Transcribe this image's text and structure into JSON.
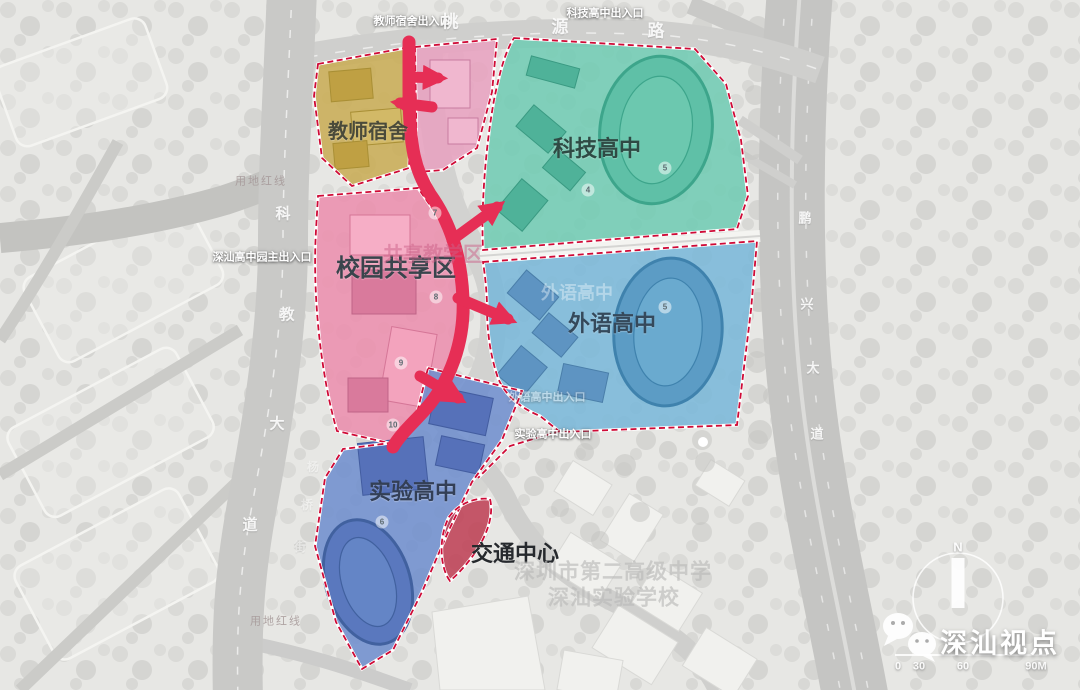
{
  "zones": {
    "teacher_dorm": {
      "label": "教师宿舍",
      "color": "#c9ac55"
    },
    "campus_shared": {
      "label": "校园共享区",
      "color": "#ec8fae"
    },
    "tech_high": {
      "label": "科技高中",
      "color": "#70cbb3"
    },
    "foreign_lang_high": {
      "label": "外语高中",
      "color": "#7ab8d9"
    },
    "experimental_high": {
      "label": "实验高中",
      "color": "#6f8fce"
    },
    "transport_center": {
      "label": "交通中心",
      "color": "#bf4055"
    }
  },
  "ghost_labels": {
    "shared_teaching": "共享教学区",
    "foreign_lang": "外语高中",
    "school_name_line1": "深圳市第二高级中学",
    "school_name_line2": "深汕实验学校"
  },
  "entrances": {
    "dorm_exit": "教师宿舍出入口",
    "tech_exit": "科技高中出入口",
    "main_entrance": "深汕高中园主出入口",
    "foreign_exit": "外语高中出入口",
    "experimental_exit": "实验高中出入口"
  },
  "roads": {
    "taoyuan": [
      "桃",
      "源",
      "路"
    ],
    "kejiao": [
      "科",
      "教",
      "大",
      "道"
    ],
    "pengxing": [
      "鹏",
      "兴",
      "大",
      "道"
    ],
    "side_street": [
      "杨",
      "桥",
      "街"
    ]
  },
  "boundary_labels": {
    "top": "用地红线",
    "bottom": "用地红线"
  },
  "badges": {
    "p7": "7",
    "p8": "8",
    "p9": "9",
    "p10": "10",
    "t4": "4",
    "t5": "5",
    "b5": "5",
    "e6": "6"
  },
  "compass": {
    "north_label": "N"
  },
  "scale_bar": {
    "labels": [
      "0",
      "30",
      "60",
      "90M"
    ]
  },
  "watermark": {
    "text": "深汕视点",
    "icon": "wechat-icon"
  },
  "colors": {
    "path_red": "#e62e55",
    "boundary_red": "#cf0a36"
  }
}
